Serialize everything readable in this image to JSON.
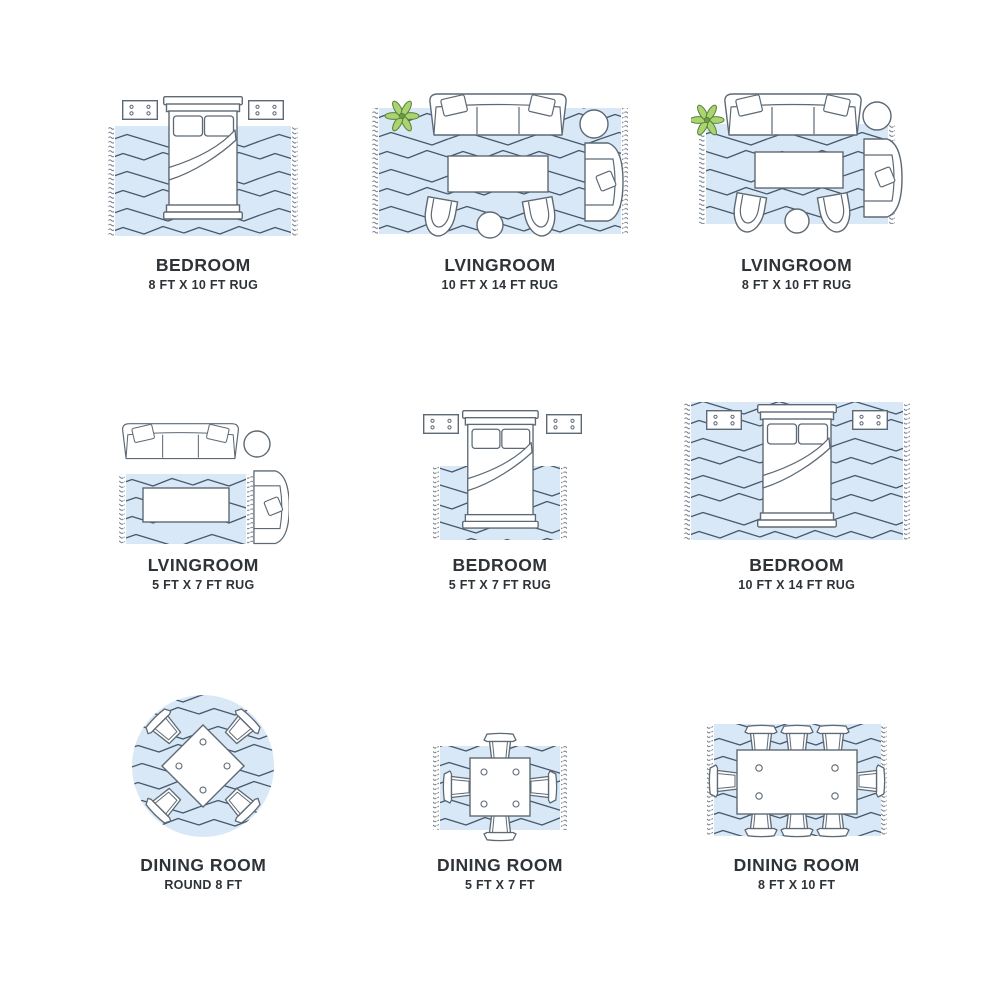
{
  "colors": {
    "rug_fill": "#d9e8f6",
    "zigzag_line": "#46586c",
    "furniture_stroke": "#5d6974",
    "fringe": "#6a7580",
    "plant_leaf": "#abd36f",
    "plant_outline": "#54803a",
    "text": "#2e3338",
    "background": "#ffffff"
  },
  "cells": [
    {
      "id": "bedroom-8x10",
      "room": "BEDROOM",
      "size": "8 FT X 10 FT RUG",
      "rug_shape": "rectangle",
      "furniture": [
        "bed",
        "nightstand",
        "nightstand"
      ]
    },
    {
      "id": "livingroom-10x14",
      "room": "LVINGROOM",
      "size": "10 FT X 14 FT RUG",
      "rug_shape": "rectangle",
      "furniture": [
        "sofa",
        "plant",
        "side-table",
        "armchair",
        "coffee-table",
        "accent-chair",
        "accent-chair",
        "ottoman"
      ]
    },
    {
      "id": "livingroom-8x10",
      "room": "LVINGROOM",
      "size": "8 FT X 10 FT RUG",
      "rug_shape": "rectangle",
      "furniture": [
        "sofa",
        "plant",
        "side-table",
        "armchair",
        "coffee-table",
        "accent-chair",
        "accent-chair",
        "ottoman"
      ]
    },
    {
      "id": "livingroom-5x7",
      "room": "LVINGROOM",
      "size": "5 FT X 7 FT RUG",
      "rug_shape": "rectangle",
      "furniture": [
        "sofa",
        "side-table",
        "armchair",
        "coffee-table"
      ]
    },
    {
      "id": "bedroom-5x7",
      "room": "BEDROOM",
      "size": "5 FT X 7 FT RUG",
      "rug_shape": "rectangle",
      "furniture": [
        "bed",
        "nightstand",
        "nightstand"
      ]
    },
    {
      "id": "bedroom-10x14",
      "room": "BEDROOM",
      "size": "10 FT X 14 FT RUG",
      "rug_shape": "rectangle",
      "furniture": [
        "bed",
        "nightstand",
        "nightstand"
      ]
    },
    {
      "id": "dining-round-8",
      "room": "DINING ROOM",
      "size": "ROUND 8 FT",
      "rug_shape": "round",
      "furniture": [
        "square-table",
        "dining-chair",
        "dining-chair",
        "dining-chair",
        "dining-chair"
      ]
    },
    {
      "id": "dining-5x7",
      "room": "DINING ROOM",
      "size": "5 FT X 7 FT",
      "rug_shape": "rectangle",
      "furniture": [
        "square-table",
        "dining-chair",
        "dining-chair",
        "dining-chair",
        "dining-chair"
      ]
    },
    {
      "id": "dining-8x10",
      "room": "DINING ROOM",
      "size": "8 FT X 10 FT",
      "rug_shape": "rectangle",
      "furniture": [
        "rect-table",
        "dining-chair",
        "dining-chair",
        "dining-chair",
        "dining-chair",
        "dining-chair",
        "dining-chair",
        "dining-chair",
        "dining-chair"
      ]
    }
  ]
}
